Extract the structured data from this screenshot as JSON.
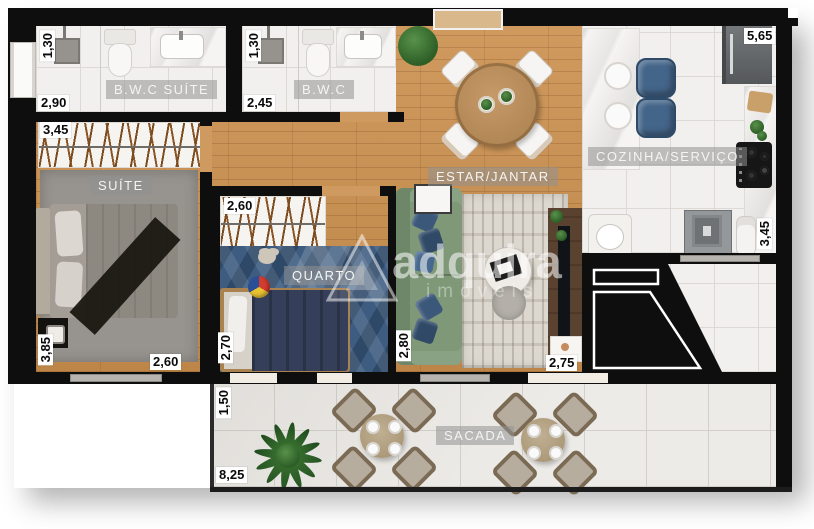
{
  "plan_type": "apartment-floor-plan",
  "rooms": {
    "bwc_suite": "B.W.C SUÍTE",
    "bwc": "B.W.C",
    "suite": "SUÍTE",
    "quarto": "QUARTO",
    "estar_jantar": "ESTAR/JANTAR",
    "cozinha_servico": "COZINHA/SERVIÇO",
    "sacada": "SACADA"
  },
  "dims": {
    "bwc_suite_depth": "1,30",
    "bwc_suite_width": "2,90",
    "bwc_depth": "1,30",
    "bwc_width": "2,45",
    "closet_width": "3,45",
    "cozinha_width": "5,65",
    "suite_depth": "3,85",
    "suite_width": "2,60",
    "quarto_width": "2,60",
    "quarto_depth": "2,70",
    "estar_depth": "2,80",
    "tv_width": "2,75",
    "servico_depth": "3,45",
    "sacada_depth": "1,50",
    "sacada_width": "8,25"
  },
  "watermark": {
    "brand": "adquira",
    "sub": "imóveis"
  },
  "colors": {
    "wall": "#0e0e0e",
    "wood_floor": "#c79154",
    "tile_floor": "#f2f0ee",
    "rug_blue": "#3d5c80",
    "sofa_green": "#7e9878",
    "stool_blue": "#44658a"
  }
}
